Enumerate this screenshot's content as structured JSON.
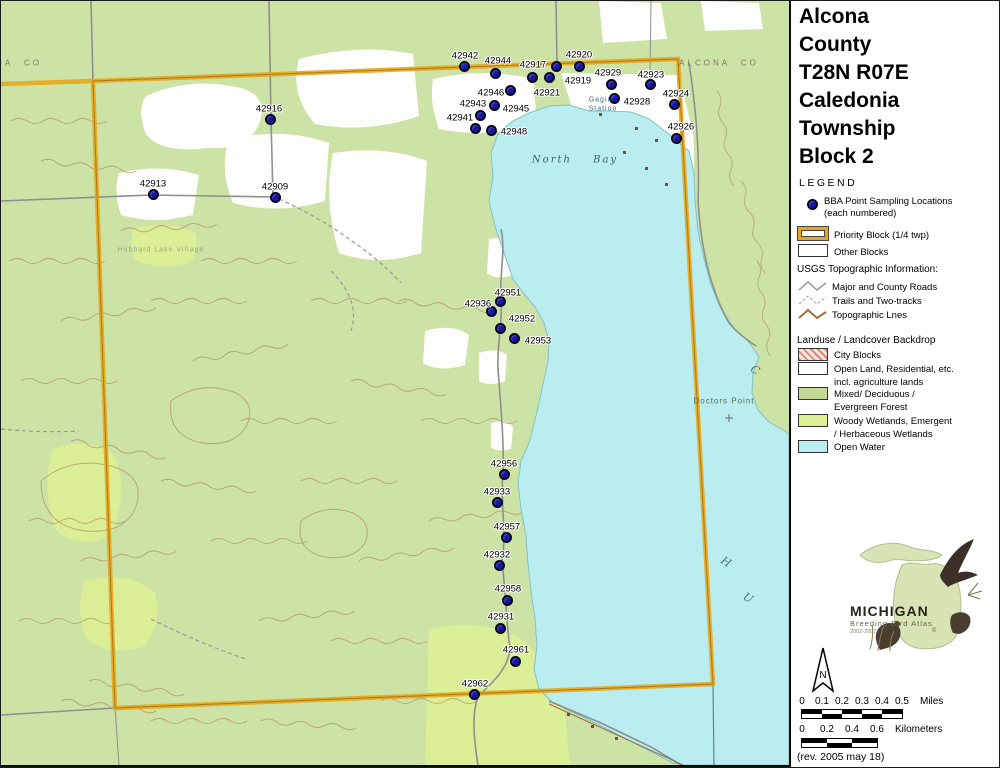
{
  "title": {
    "lines": [
      "Alcona",
      "County",
      "T28N R07E",
      "Caledonia",
      "Township",
      "Block 2"
    ]
  },
  "legend": {
    "heading": "LEGEND",
    "points_label1": "BBA Point Sampling Locations",
    "points_label2": "(each numbered)",
    "priority_label": "Priority Block (1/4 twp)",
    "other_label": "Other Blocks",
    "usgs_heading": "USGS Topographic Information:",
    "usgs_items": [
      "Major and County Roads",
      "Trails and Two-tracks",
      "Topographic Lnes"
    ],
    "landuse_heading": "Landuse / Landcover Backdrop",
    "landuse_items": [
      {
        "label": "City Blocks",
        "label2": ""
      },
      {
        "label": "Open Land, Residential, etc.",
        "label2": "incl. agriculture lands"
      },
      {
        "label": "Mixed/ Deciduous /",
        "label2": "Evergreen Forest"
      },
      {
        "label": "Woody Wetlands, Emergent",
        "label2": "/ Herbaceous Wetlands"
      },
      {
        "label": "Open Water",
        "label2": ""
      }
    ]
  },
  "logo": {
    "name": "MICHIGAN",
    "subtitle": "Breeding Bird Atlas",
    "years": "2002-2007",
    "numeral": "II"
  },
  "north_label": "N",
  "scale": {
    "miles_ticks": [
      "0",
      "0.1",
      "0.2",
      "0.3",
      "0.4",
      "0.5"
    ],
    "miles_unit": "Miles",
    "km_ticks": [
      "0",
      "0.2",
      "0.4",
      "0.6"
    ],
    "km_unit": "Kilometers"
  },
  "revision": "(rev. 2005 may 18)",
  "colors": {
    "priority_orange": "#e8a81c",
    "point_blue": "#1717a0",
    "open_water": "#b9edef",
    "forest_green": "#cde3a5",
    "wetland_green": "#ddf095",
    "contour_brown": "#a9845a"
  },
  "map": {
    "labels": [
      {
        "text": "North Bay",
        "x": 574,
        "y": 159,
        "cls": "bay"
      },
      {
        "text": "Gaging",
        "x": 602,
        "y": 99,
        "cls": "station"
      },
      {
        "text": "Station",
        "x": 602,
        "y": 108,
        "cls": "station"
      },
      {
        "text": "ALCONA CO",
        "x": 718,
        "y": 62,
        "cls": "county"
      },
      {
        "text": "NA CO",
        "x": 18,
        "y": 62,
        "cls": "county"
      },
      {
        "text": "Doctors Point",
        "x": 723,
        "y": 400,
        "cls": "place"
      },
      {
        "text": "C",
        "x": 754,
        "y": 369,
        "cls": "lakeletter"
      },
      {
        "text": "H",
        "x": 725,
        "y": 561,
        "cls": "lakeletter"
      },
      {
        "text": "U",
        "x": 747,
        "y": 597,
        "cls": "lakeletter"
      },
      {
        "text": "Hubbard Lake Village",
        "x": 160,
        "y": 249,
        "cls": "faint"
      }
    ],
    "points": [
      {
        "id": "42942",
        "dot": [
          463,
          65
        ],
        "label": [
          464,
          55
        ]
      },
      {
        "id": "42944",
        "dot": [
          494,
          72
        ],
        "label": [
          497,
          60
        ]
      },
      {
        "id": "42917",
        "dot": [
          555,
          65
        ],
        "label": [
          532,
          64
        ]
      },
      {
        "id": "42920",
        "dot": [
          578,
          65
        ],
        "label": [
          578,
          54
        ]
      },
      {
        "id": "42919",
        "dot": [
          548,
          76
        ],
        "label": [
          577,
          80
        ]
      },
      {
        "id": "42946",
        "dot": [
          509,
          89
        ],
        "label": [
          490,
          92
        ]
      },
      {
        "id": "42921",
        "dot": [
          531,
          76
        ],
        "label": [
          546,
          92
        ]
      },
      {
        "id": "42929",
        "dot": [
          610,
          83
        ],
        "label": [
          607,
          72
        ]
      },
      {
        "id": "42923",
        "dot": [
          649,
          83
        ],
        "label": [
          650,
          74
        ]
      },
      {
        "id": "42928",
        "dot": [
          613,
          97
        ],
        "label": [
          636,
          101
        ]
      },
      {
        "id": "42924",
        "dot": [
          673,
          103
        ],
        "label": [
          675,
          93
        ]
      },
      {
        "id": "42926",
        "dot": [
          675,
          137
        ],
        "label": [
          680,
          126
        ]
      },
      {
        "id": "42943",
        "dot": [
          479,
          114
        ],
        "label": [
          472,
          103
        ]
      },
      {
        "id": "42945",
        "dot": [
          493,
          104
        ],
        "label": [
          515,
          108
        ]
      },
      {
        "id": "42941",
        "dot": [
          474,
          127
        ],
        "label": [
          459,
          117
        ]
      },
      {
        "id": "42948",
        "dot": [
          490,
          129
        ],
        "label": [
          513,
          131
        ]
      },
      {
        "id": "42916",
        "dot": [
          269,
          118
        ],
        "label": [
          268,
          108
        ]
      },
      {
        "id": "42913",
        "dot": [
          152,
          193
        ],
        "label": [
          152,
          183
        ]
      },
      {
        "id": "42909",
        "dot": [
          274,
          196
        ],
        "label": [
          274,
          186
        ]
      },
      {
        "id": "42951",
        "dot": [
          499,
          300
        ],
        "label": [
          507,
          292
        ]
      },
      {
        "id": "42936",
        "dot": [
          490,
          310
        ],
        "label": [
          477,
          303
        ]
      },
      {
        "id": "42952",
        "dot": [
          499,
          327
        ],
        "label": [
          521,
          318
        ]
      },
      {
        "id": "42953",
        "dot": [
          513,
          337
        ],
        "label": [
          537,
          340
        ]
      },
      {
        "id": "42956",
        "dot": [
          503,
          473
        ],
        "label": [
          503,
          463
        ]
      },
      {
        "id": "42933",
        "dot": [
          496,
          501
        ],
        "label": [
          496,
          491
        ]
      },
      {
        "id": "42957",
        "dot": [
          505,
          536
        ],
        "label": [
          506,
          526
        ]
      },
      {
        "id": "42932",
        "dot": [
          498,
          564
        ],
        "label": [
          496,
          554
        ]
      },
      {
        "id": "42958",
        "dot": [
          506,
          599
        ],
        "label": [
          507,
          588
        ]
      },
      {
        "id": "42931",
        "dot": [
          499,
          627
        ],
        "label": [
          500,
          616
        ]
      },
      {
        "id": "42961",
        "dot": [
          514,
          660
        ],
        "label": [
          515,
          649
        ]
      },
      {
        "id": "42962",
        "dot": [
          473,
          693
        ],
        "label": [
          474,
          683
        ]
      }
    ]
  }
}
